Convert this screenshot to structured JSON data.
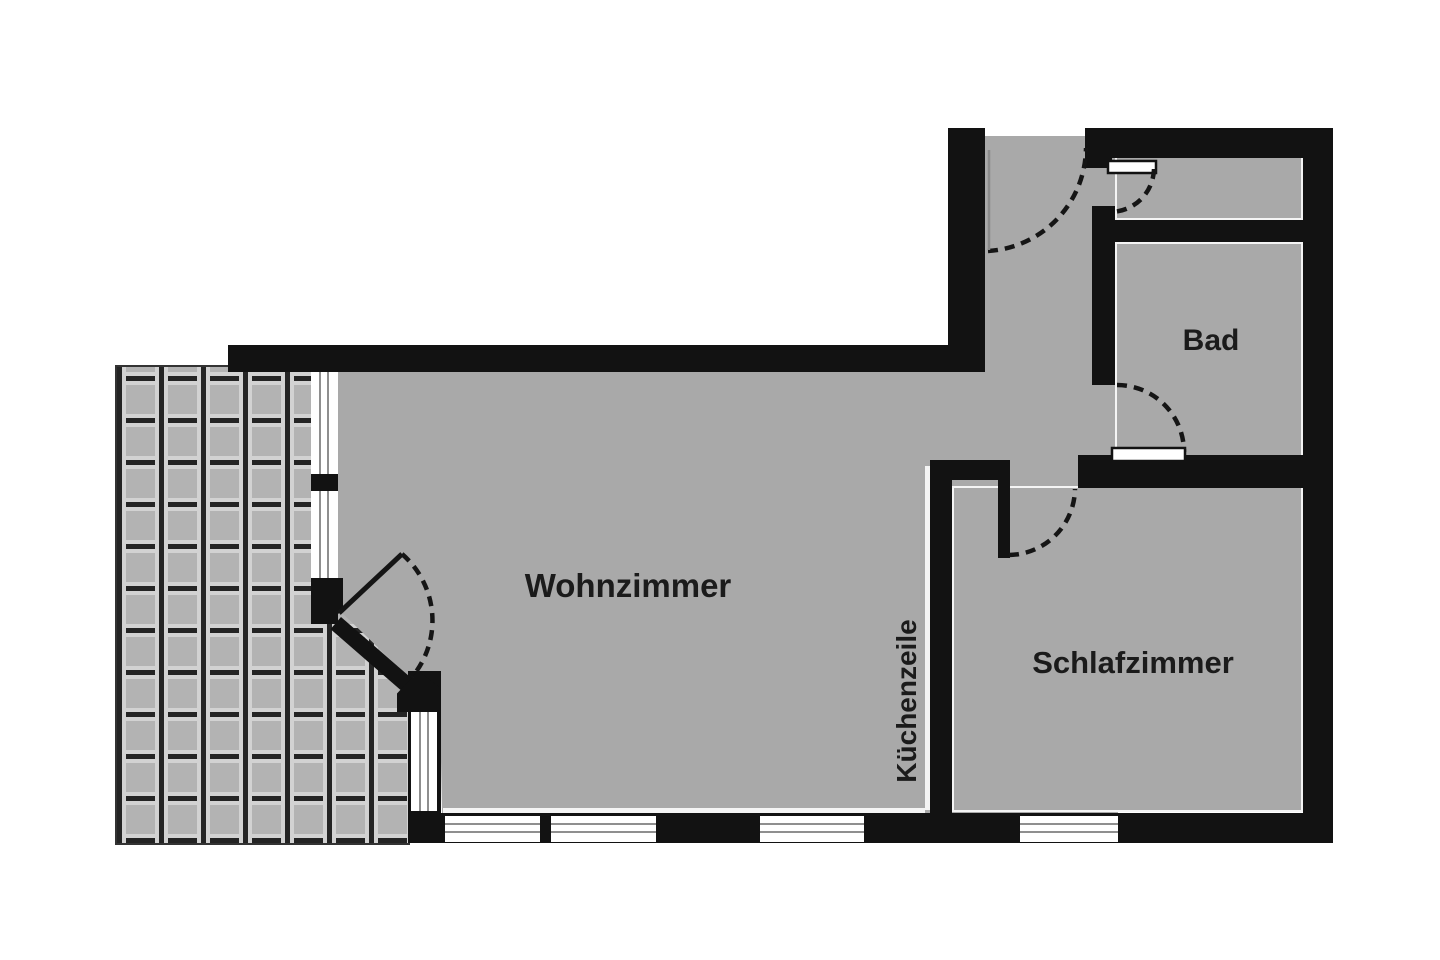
{
  "plan": {
    "title": "Grundriss",
    "rooms": {
      "wohnzimmer": {
        "label": "Wohnzimmer"
      },
      "schlafzimmer": {
        "label": "Schlafzimmer"
      },
      "bad": {
        "label": "Bad"
      },
      "kuechenzeile": {
        "label": "Küchenzeile"
      }
    },
    "colors": {
      "background": "#ffffff",
      "floor": "#a9a9a9",
      "wall": "#121212",
      "room_outline": "#f4f4f4",
      "tile_base": "#b3b3b3",
      "tile_grout": "#242424",
      "tile_highlight": "#d2d2d2",
      "window_glass": "#ffffff",
      "window_line": "#8f8f8f",
      "door_arc": "#151515",
      "text": "#1b1b1b"
    }
  }
}
